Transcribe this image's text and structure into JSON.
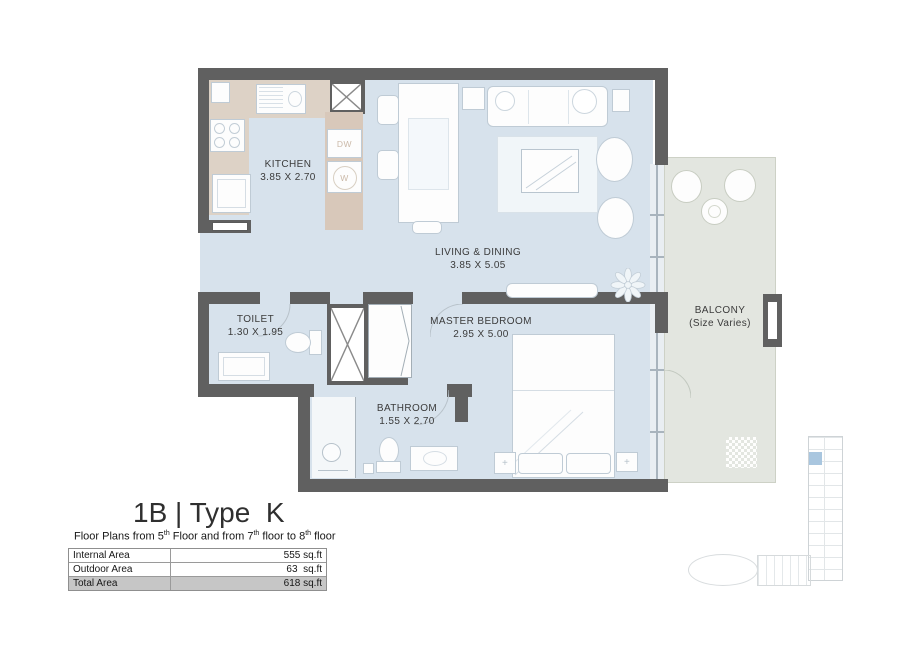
{
  "plan": {
    "rooms": {
      "kitchen": {
        "name": "KITCHEN",
        "dims": "3.85 X 2.70"
      },
      "living": {
        "name": "LIVING & DINING",
        "dims": "3.85 X 5.05"
      },
      "toilet": {
        "name": "TOILET",
        "dims": "1.30 X 1.95"
      },
      "bathroom": {
        "name": "BATHROOM",
        "dims": "1.55 X 2.70"
      },
      "master_bedroom": {
        "name": "MASTER BEDROOM",
        "dims": "2.95 X 5.00"
      },
      "balcony": {
        "name": "BALCONY",
        "dims": "(Size Varies)"
      }
    },
    "appliance_labels": {
      "dishwasher": "DW",
      "washer": "W"
    },
    "markers": {
      "nightstand": "+"
    }
  },
  "title_block": {
    "title": "1B | Type  K",
    "subtitle_parts": {
      "p1": "Floor Plans from 5",
      "s1": "th",
      "p2": " Floor and from 7",
      "s2": "th",
      "p3": " floor to 8",
      "s3": "th",
      "p4": " floor"
    },
    "area_table": {
      "rows": [
        {
          "label": "Internal Area",
          "value": "555 sq.ft"
        },
        {
          "label": "Outdoor Area",
          "value": "63  sq.ft"
        },
        {
          "label": "Total Area",
          "value": "618 sq.ft"
        }
      ]
    }
  },
  "colors": {
    "wall": "#606060",
    "floor": "#d7e2ec",
    "balcony_floor": "#e3e6e0",
    "kitchen_counter": "#ddd2c6",
    "highlight_unit": "#a9c6df",
    "table_total_row": "#c6c6c6"
  }
}
